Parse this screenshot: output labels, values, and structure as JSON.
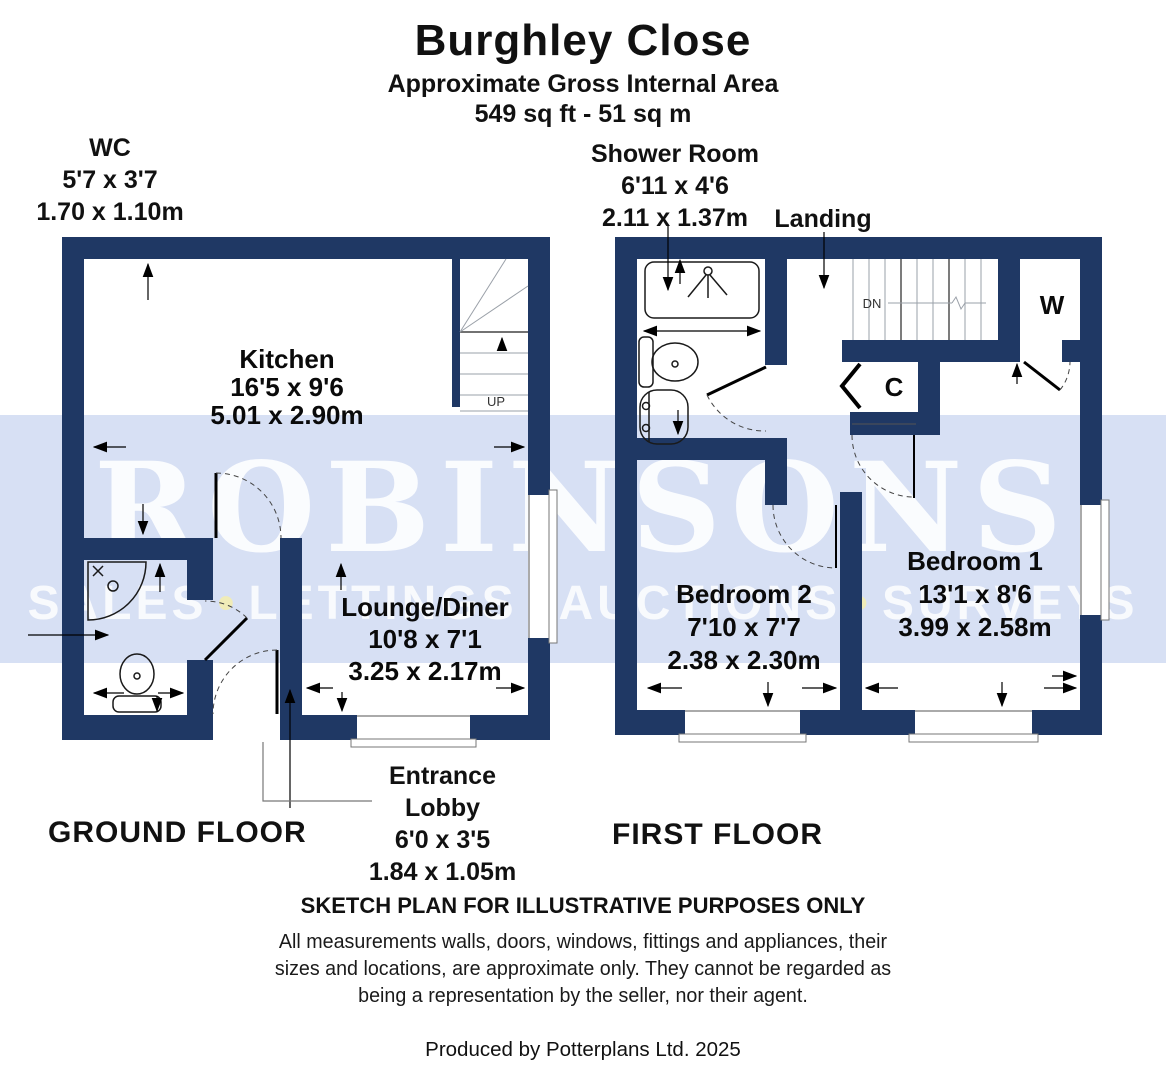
{
  "title": {
    "property_name": "Burghley Close",
    "subtitle": "Approximate Gross Internal Area",
    "area": "549 sq ft - 51 sq m"
  },
  "watermark": {
    "brand": "ROBINSONS",
    "services": [
      "SALES",
      "LETTINGS",
      "AUCTIONS",
      "SURVEYS"
    ],
    "bullet": "•",
    "band_color": "#d7e0f4"
  },
  "colors": {
    "wall_navy": "#1f3864",
    "label_black": "#111111"
  },
  "ground_floor": {
    "floor_label": "GROUND FLOOR",
    "stairs_label": "UP",
    "rooms": [
      {
        "name": "WC",
        "imperial": "5'7 x 3'7",
        "metric": "1.70 x 1.10m"
      },
      {
        "name": "Kitchen",
        "imperial": "16'5 x 9'6",
        "metric": "5.01 x 2.90m"
      },
      {
        "name": "Lounge/Diner",
        "imperial": "10'8 x 7'1",
        "metric": "3.25 x 2.17m"
      },
      {
        "name": "Entrance Lobby",
        "imperial": "6'0 x 3'5",
        "metric": "1.84 x 1.05m"
      }
    ]
  },
  "first_floor": {
    "floor_label": "FIRST FLOOR",
    "stairs_label": "DN",
    "wardrobe_label": "W",
    "cupboard_label": "C",
    "rooms": [
      {
        "name": "Shower Room",
        "imperial": "6'11 x 4'6",
        "metric": "2.11 x 1.37m"
      },
      {
        "name": "Landing"
      },
      {
        "name": "Bedroom 2",
        "imperial": "7'10 x 7'7",
        "metric": "2.38 x 2.30m"
      },
      {
        "name": "Bedroom 1",
        "imperial": "13'1 x 8'6",
        "metric": "3.99 x 2.58m"
      }
    ]
  },
  "footer": {
    "sketch_note": "SKETCH PLAN FOR ILLUSTRATIVE PURPOSES ONLY",
    "disclaimer_lines": [
      "All measurements walls, doors, windows, fittings and appliances, their",
      "sizes and locations, are approximate only. They cannot be regarded as",
      "being a representation by the seller, nor their agent."
    ],
    "credit": "Produced by Potterplans Ltd. 2025"
  }
}
